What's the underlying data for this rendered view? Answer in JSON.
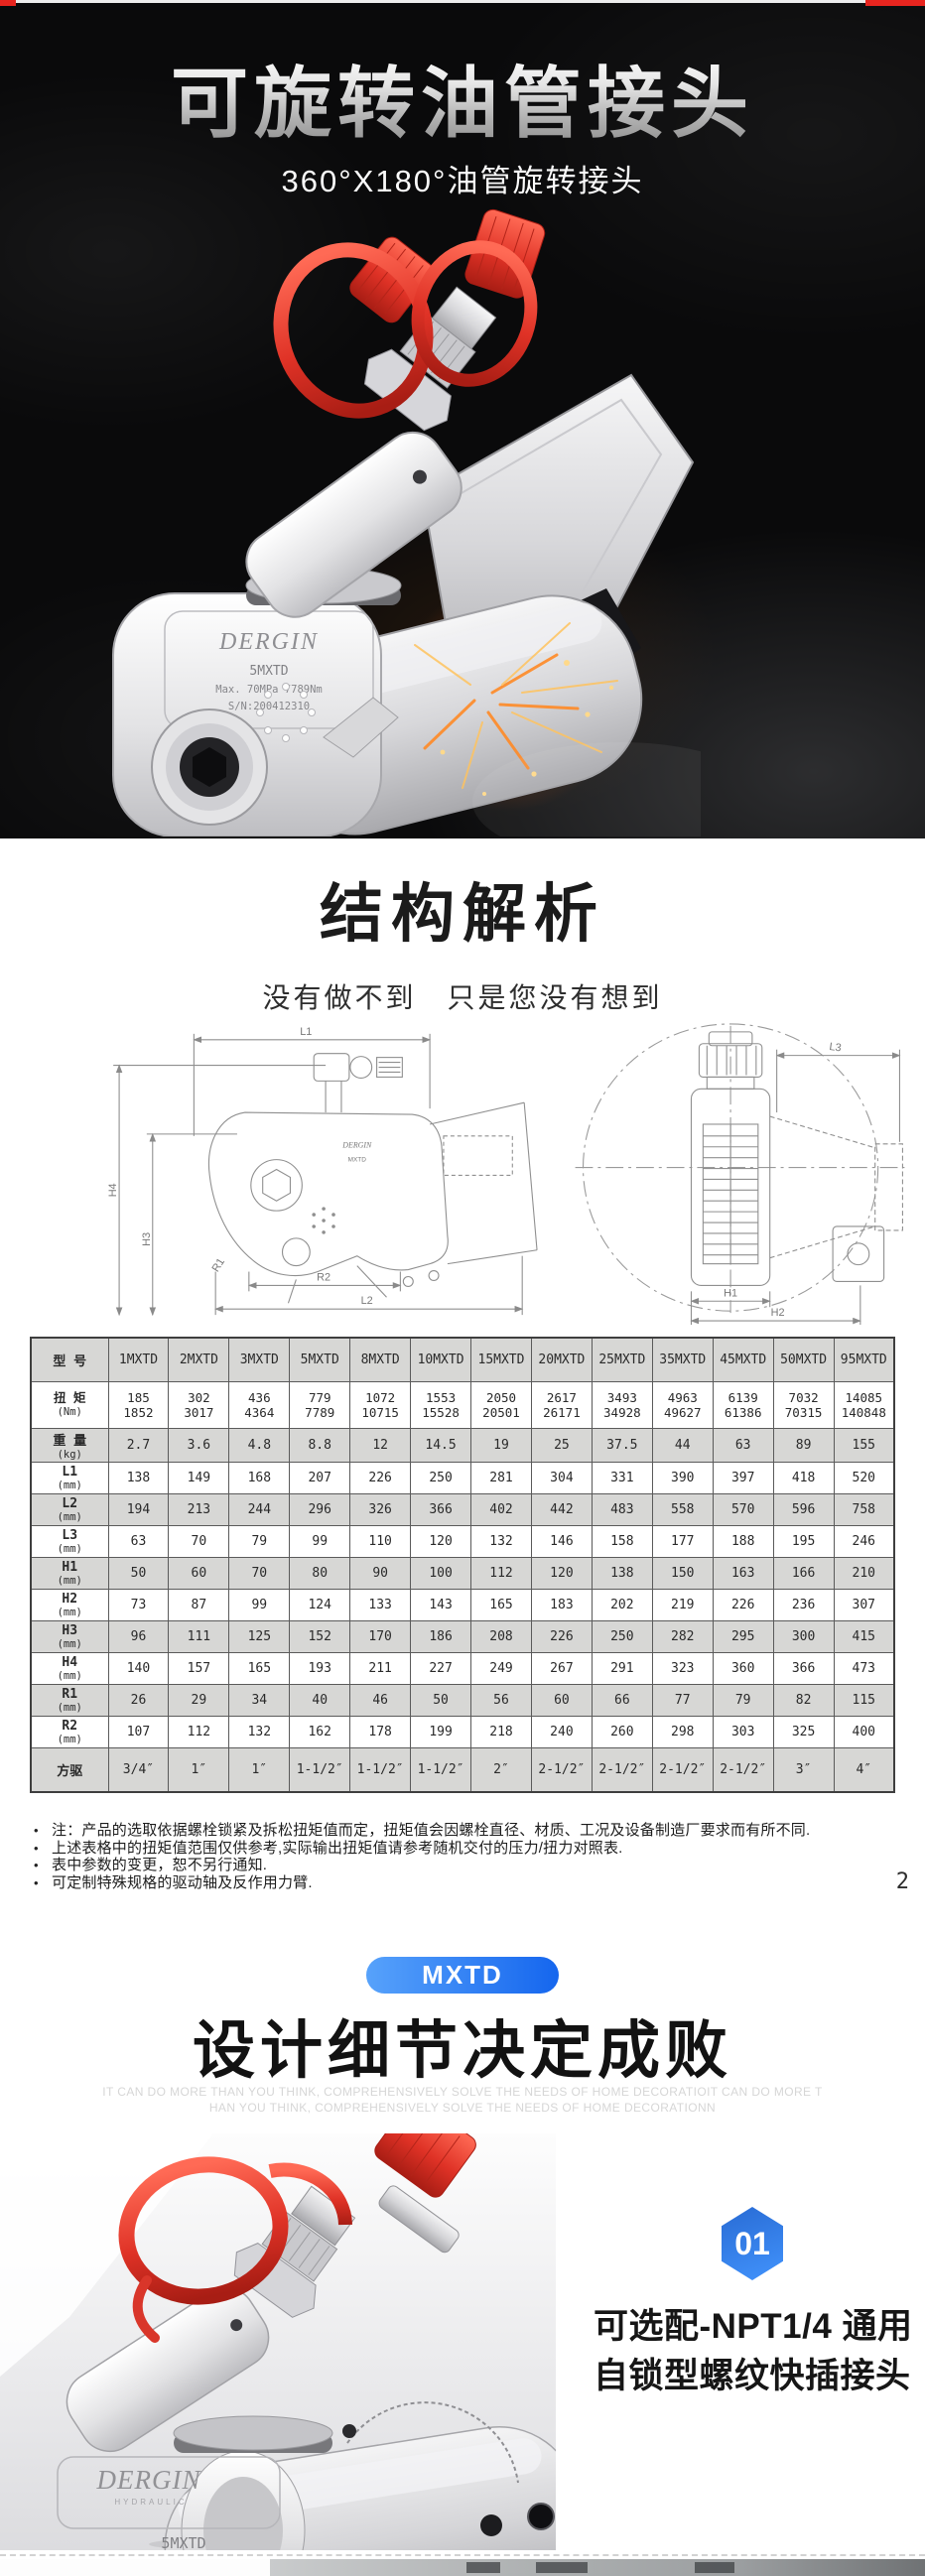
{
  "page": {
    "number": "2"
  },
  "hero": {
    "title": "可旋转油管接头",
    "subtitle": "360°X180°油管旋转接头",
    "product": {
      "brand": "DERGIN",
      "brand_tagline": "HYDRAULIC",
      "model": "5MXTD",
      "rating": "Max. 70MPa 7789Nm",
      "serial": "S/N:200412310"
    }
  },
  "structure": {
    "heading": "结构解析",
    "subheading": "没有做不到　只是您没有想到",
    "side_view_labels": {
      "l1": "L1",
      "h4": "H4",
      "h3": "H3",
      "r1": "R1",
      "r2": "R2",
      "l2": "L2"
    },
    "front_view_labels": {
      "l3": "L3",
      "h1": "H1",
      "h2": "H2"
    }
  },
  "spec_table": {
    "col_header_label": "型 号",
    "models": [
      "1MXTD",
      "2MXTD",
      "3MXTD",
      "5MXTD",
      "8MXTD",
      "10MXTD",
      "15MXTD",
      "20MXTD",
      "25MXTD",
      "35MXTD",
      "45MXTD",
      "50MXTD",
      "95MXTD"
    ],
    "rows": [
      {
        "label": "扭 矩",
        "unit": "(Nm)",
        "values": [
          "185|1852",
          "302|3017",
          "436|4364",
          "779|7789",
          "1072|10715",
          "1553|15528",
          "2050|20501",
          "2617|26171",
          "3493|34928",
          "4963|49627",
          "6139|61386",
          "7032|70315",
          "14085|140848"
        ]
      },
      {
        "label": "重 量",
        "unit": "(kg)",
        "values": [
          "2.7",
          "3.6",
          "4.8",
          "8.8",
          "12",
          "14.5",
          "19",
          "25",
          "37.5",
          "44",
          "63",
          "89",
          "155"
        ]
      },
      {
        "label": "L1",
        "unit": "(mm)",
        "values": [
          "138",
          "149",
          "168",
          "207",
          "226",
          "250",
          "281",
          "304",
          "331",
          "390",
          "397",
          "418",
          "520"
        ]
      },
      {
        "label": "L2",
        "unit": "(mm)",
        "values": [
          "194",
          "213",
          "244",
          "296",
          "326",
          "366",
          "402",
          "442",
          "483",
          "558",
          "570",
          "596",
          "758"
        ]
      },
      {
        "label": "L3",
        "unit": "(mm)",
        "values": [
          "63",
          "70",
          "79",
          "99",
          "110",
          "120",
          "132",
          "146",
          "158",
          "177",
          "188",
          "195",
          "246"
        ]
      },
      {
        "label": "H1",
        "unit": "(mm)",
        "values": [
          "50",
          "60",
          "70",
          "80",
          "90",
          "100",
          "112",
          "120",
          "138",
          "150",
          "163",
          "166",
          "210"
        ]
      },
      {
        "label": "H2",
        "unit": "(mm)",
        "values": [
          "73",
          "87",
          "99",
          "124",
          "133",
          "143",
          "165",
          "183",
          "202",
          "219",
          "226",
          "236",
          "307"
        ]
      },
      {
        "label": "H3",
        "unit": "(mm)",
        "values": [
          "96",
          "111",
          "125",
          "152",
          "170",
          "186",
          "208",
          "226",
          "250",
          "282",
          "295",
          "300",
          "415"
        ]
      },
      {
        "label": "H4",
        "unit": "(mm)",
        "values": [
          "140",
          "157",
          "165",
          "193",
          "211",
          "227",
          "249",
          "267",
          "291",
          "323",
          "360",
          "366",
          "473"
        ]
      },
      {
        "label": "R1",
        "unit": "(mm)",
        "values": [
          "26",
          "29",
          "34",
          "40",
          "46",
          "50",
          "56",
          "60",
          "66",
          "77",
          "79",
          "82",
          "115"
        ]
      },
      {
        "label": "R2",
        "unit": "(mm)",
        "values": [
          "107",
          "112",
          "132",
          "162",
          "178",
          "199",
          "218",
          "240",
          "260",
          "298",
          "303",
          "325",
          "400"
        ]
      },
      {
        "label": "方驱",
        "unit": "",
        "values": [
          "3/4″",
          "1″",
          "1″",
          "1-1/2″",
          "1-1/2″",
          "1-1/2″",
          "2″",
          "2-1/2″",
          "2-1/2″",
          "2-1/2″",
          "2-1/2″",
          "3″",
          "4″"
        ]
      }
    ]
  },
  "notes": [
    "注：产品的选取依据螺栓锁紧及拆松扭矩值而定，扭矩值会因螺栓直径、材质、工况及设备制造厂要求而有所不同.",
    "上述表格中的扭矩值范围仅供参考,实际输出扭矩值请参考随机交付的压力/扭力对照表.",
    "表中参数的变更，恕不另行通知.",
    "可定制特殊规格的驱动轴及反作用力臂."
  ],
  "design": {
    "badge": "MXTD",
    "heading": "设计细节决定成败",
    "caption_en_line1": "IT CAN DO MORE THAN YOU THINK, COMPREHENSIVELY SOLVE THE NEEDS OF HOME DECORATIOIT CAN DO MORE T",
    "caption_en_line2": "HAN YOU THINK, COMPREHENSIVELY SOLVE THE NEEDS OF HOME DECORATIONN"
  },
  "feature": {
    "index": "01",
    "description": "可选配-NPT1/4 通用自锁型螺纹快插接头"
  },
  "colors": {
    "accent_blue": "#2f7bf0",
    "badge_gradient_start": "#57a2fb",
    "badge_gradient_end": "#1566ee",
    "connector_red": "#e03428",
    "table_gray": "#d7d7d5"
  }
}
